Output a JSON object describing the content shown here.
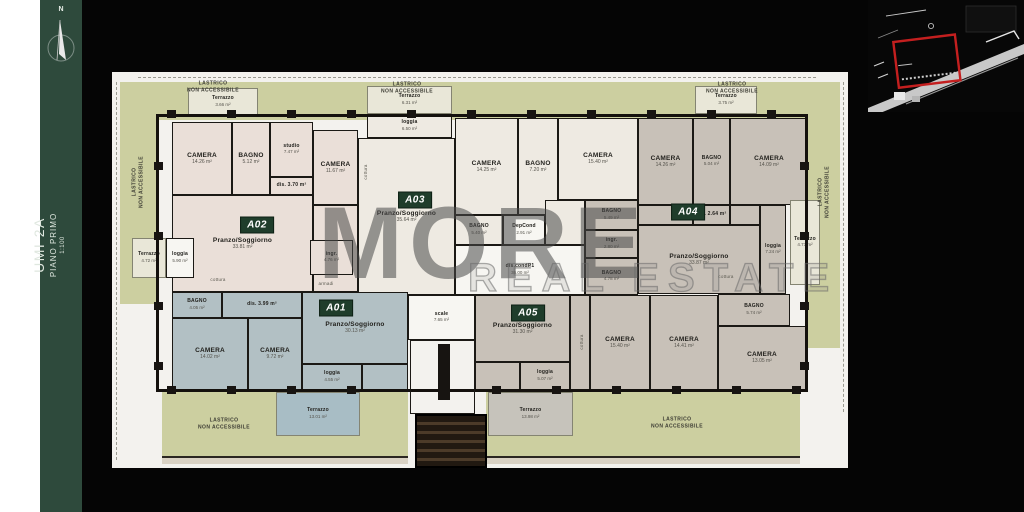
{
  "sidebar": {
    "north": "N",
    "title": "UMI 2A",
    "subtitle": "PIANO PRIMO",
    "scale": "1:100",
    "band_color": "#2e4a3c"
  },
  "watermark": {
    "primary": "MORE",
    "secondary": "REAL ESTATE"
  },
  "inset": {
    "highlight_color": "#c41f1f"
  },
  "palette": {
    "paper": "#f3f2ee",
    "green": "#cccfa0",
    "pale": "#e9e7d8",
    "wall": "#171411",
    "a01": "#b2c0c4",
    "a02": "#eadfd8",
    "a03": "#eeeae2",
    "a04": "#c8c1b8",
    "a05": "#c8c1b8",
    "wt": "#f7f6f2",
    "tblue": "#a8bdc5",
    "tgray": "#c6c3bb",
    "badge_bg": "#1f3d2b",
    "badge_fg": "#ffffff"
  },
  "plan": {
    "regions": [
      {
        "name": "lastrico-top",
        "fill": "green",
        "cls": "flat",
        "x": 26,
        "y": 10,
        "w": 678,
        "h": 38
      },
      {
        "name": "lastrico-left",
        "fill": "green",
        "cls": "flat",
        "x": 8,
        "y": 10,
        "w": 38,
        "h": 222
      },
      {
        "name": "lastrico-right",
        "fill": "green",
        "cls": "flat",
        "x": 694,
        "y": 10,
        "w": 34,
        "h": 266
      },
      {
        "name": "lastrico-bottom-left",
        "fill": "green",
        "cls": "flat",
        "x": 50,
        "y": 320,
        "w": 246,
        "h": 64
      },
      {
        "name": "lastrico-bottom-right",
        "fill": "green",
        "cls": "flat",
        "x": 374,
        "y": 320,
        "w": 314,
        "h": 64
      },
      {
        "name": "parapet-left",
        "cls": "bwall",
        "x": 50,
        "y": 384,
        "w": 246,
        "h": 8
      },
      {
        "name": "parapet-right",
        "cls": "bwall",
        "x": 374,
        "y": 384,
        "w": 314,
        "h": 8
      },
      {
        "name": "terrazzo-a02-top",
        "fill": "pale",
        "cls": "terr",
        "x": 76,
        "y": 16,
        "w": 70,
        "h": 28,
        "label": "Terrazzo",
        "area": "3.66 m²",
        "sm": 1
      },
      {
        "name": "terrazzo-a03-top",
        "fill": "pale",
        "cls": "terr",
        "x": 255,
        "y": 14,
        "w": 85,
        "h": 28,
        "label": "Terrazzo",
        "area": "6.31 m²",
        "sm": 1
      },
      {
        "name": "terrazzo-a04-top",
        "fill": "pale",
        "cls": "terr",
        "x": 583,
        "y": 14,
        "w": 62,
        "h": 28,
        "label": "Terrazzo",
        "area": "3.75 m²",
        "sm": 1
      },
      {
        "name": "room-a02-camera-1",
        "fill": "a02",
        "x": 60,
        "y": 50,
        "w": 60,
        "h": 73,
        "label": "CAMERA",
        "area": "14.26 m²"
      },
      {
        "name": "room-a02-bagno",
        "fill": "a02",
        "x": 120,
        "y": 50,
        "w": 38,
        "h": 73,
        "label": "BAGNO",
        "area": "5.12 m²"
      },
      {
        "name": "room-a02-studio",
        "fill": "a02",
        "x": 158,
        "y": 50,
        "w": 43,
        "h": 55,
        "label": "studio",
        "area": "7.47 m²",
        "sm": 1
      },
      {
        "name": "room-a02-dis",
        "fill": "a02",
        "x": 158,
        "y": 105,
        "w": 43,
        "h": 18,
        "label": "dis. 3.70 m²",
        "sm": 1
      },
      {
        "name": "room-a02-camera-2",
        "fill": "a02",
        "x": 201,
        "y": 58,
        "w": 45,
        "h": 75,
        "label": "CAMERA",
        "area": "11.67 m²"
      },
      {
        "name": "a02-hall",
        "fill": "a02",
        "x": 201,
        "y": 133,
        "w": 45,
        "h": 87
      },
      {
        "name": "room-a02-pranzo",
        "fill": "a02",
        "x": 60,
        "y": 123,
        "w": 141,
        "h": 97,
        "label": "Pranzo/Soggiorno",
        "area": "33.81 m²"
      },
      {
        "name": "room-a02-ingr",
        "fill": "a02",
        "x": 198,
        "y": 168,
        "w": 43,
        "h": 35,
        "label": "ingr.",
        "area": "4.76 m²",
        "sm": 1
      },
      {
        "name": "terrazzo-a02-left",
        "fill": "pale",
        "cls": "terr",
        "x": 20,
        "y": 166,
        "w": 34,
        "h": 40,
        "label": "Terrazzo",
        "area": "4.72 m²",
        "sm": 1
      },
      {
        "name": "room-a02-loggia",
        "fill": "wt",
        "x": 54,
        "y": 166,
        "w": 28,
        "h": 40,
        "label": "loggia",
        "area": "5.90 m²",
        "sm": 1
      },
      {
        "name": "room-a03-loggia",
        "fill": "a03",
        "x": 255,
        "y": 42,
        "w": 85,
        "h": 24,
        "label": "loggia",
        "area": "6.50 m²",
        "sm": 1
      },
      {
        "name": "room-a03-pranzo",
        "fill": "a03",
        "x": 246,
        "y": 66,
        "w": 97,
        "h": 157,
        "label": "Pranzo/Soggiorno",
        "area": "35.64 m²"
      },
      {
        "name": "room-a03-camera-1",
        "fill": "a03",
        "x": 343,
        "y": 46,
        "w": 63,
        "h": 97,
        "label": "CAMERA",
        "area": "14.25 m²"
      },
      {
        "name": "room-a03-bagno-1",
        "fill": "a03",
        "x": 406,
        "y": 46,
        "w": 40,
        "h": 97,
        "label": "BAGNO",
        "area": "7.20 m²"
      },
      {
        "name": "room-a03-camera-2",
        "fill": "a03",
        "x": 446,
        "y": 46,
        "w": 80,
        "h": 82,
        "label": "CAMERA",
        "area": "15.40 m²"
      },
      {
        "name": "a03-hall",
        "fill": "a03",
        "x": 433,
        "y": 128,
        "w": 40,
        "h": 45
      },
      {
        "name": "room-a03-bagno-2",
        "fill": "a03",
        "x": 343,
        "y": 143,
        "w": 48,
        "h": 30,
        "label": "BAGNO",
        "area": "5.40 m²",
        "sm": 1
      },
      {
        "name": "room-depcond",
        "fill": "wt",
        "x": 391,
        "y": 143,
        "w": 42,
        "h": 30,
        "label": "DepCond",
        "area": "2.91 m²",
        "sm": 1
      },
      {
        "name": "corridor-discond",
        "fill": "wt",
        "x": 343,
        "y": 173,
        "w": 130,
        "h": 50,
        "label": "dis.condP1",
        "area": "36.00 m²",
        "sm": 1
      },
      {
        "name": "room-a04-camera-1",
        "fill": "a04",
        "x": 526,
        "y": 46,
        "w": 55,
        "h": 87,
        "label": "CAMERA",
        "area": "14.26 m²"
      },
      {
        "name": "room-a04-bagno-1",
        "fill": "a04",
        "x": 581,
        "y": 46,
        "w": 37,
        "h": 87,
        "label": "BAGNO",
        "area": "5.04 m²",
        "sm": 1
      },
      {
        "name": "room-a04-camera-2",
        "fill": "a04",
        "x": 618,
        "y": 46,
        "w": 78,
        "h": 87,
        "label": "CAMERA",
        "area": "14.09 m²"
      },
      {
        "name": "room-a04-dis",
        "fill": "a04",
        "x": 581,
        "y": 133,
        "w": 37,
        "h": 20,
        "label": "dis. 2.64 m²",
        "sm": 1
      },
      {
        "name": "a04-hall",
        "fill": "a04",
        "x": 526,
        "y": 133,
        "w": 55,
        "h": 20
      },
      {
        "name": "a04-hall-2",
        "fill": "a04",
        "x": 618,
        "y": 133,
        "w": 30,
        "h": 20
      },
      {
        "name": "room-a04-bagno-2",
        "fill": "a04",
        "x": 473,
        "y": 128,
        "w": 53,
        "h": 30,
        "label": "BAGNO",
        "area": "5.49 m²",
        "sm": 1
      },
      {
        "name": "room-a04-ingr",
        "fill": "a04",
        "x": 473,
        "y": 158,
        "w": 53,
        "h": 28,
        "label": "ingr.",
        "area": "2.80 m²",
        "sm": 1
      },
      {
        "name": "room-a04-bagno-3",
        "fill": "a04",
        "x": 473,
        "y": 186,
        "w": 53,
        "h": 37,
        "label": "BAGNO",
        "area": "4.78 m²",
        "sm": 1
      },
      {
        "name": "room-a04-pranzo",
        "fill": "a04",
        "x": 526,
        "y": 153,
        "w": 122,
        "h": 69,
        "label": "Pranzo/Soggiorno",
        "area": "33.87 m²"
      },
      {
        "name": "room-a04-loggia",
        "fill": "a04",
        "x": 648,
        "y": 133,
        "w": 26,
        "h": 89,
        "label": "loggia",
        "area": "7.24 m²",
        "sm": 1
      },
      {
        "name": "terrazzo-a04-right",
        "fill": "pale",
        "cls": "terr",
        "x": 678,
        "y": 128,
        "w": 30,
        "h": 85,
        "label": "Terrazzo",
        "area": "4.73 m²",
        "sm": 1
      },
      {
        "name": "room-a05-pranzo",
        "fill": "a05",
        "x": 363,
        "y": 223,
        "w": 95,
        "h": 67,
        "label": "Pranzo/Soggiorno",
        "area": "31.30 m²"
      },
      {
        "name": "a05-hall",
        "fill": "a05",
        "x": 458,
        "y": 223,
        "w": 20,
        "h": 95
      },
      {
        "name": "a05-hall-2",
        "fill": "a05",
        "x": 363,
        "y": 290,
        "w": 45,
        "h": 28
      },
      {
        "name": "room-a05-camera-1",
        "fill": "a05",
        "x": 478,
        "y": 223,
        "w": 60,
        "h": 95,
        "label": "CAMERA",
        "area": "15.40 m²"
      },
      {
        "name": "room-a05-camera-2",
        "fill": "a05",
        "x": 538,
        "y": 223,
        "w": 68,
        "h": 95,
        "label": "CAMERA",
        "area": "14.41 m²"
      },
      {
        "name": "room-a05-bagno",
        "fill": "a05",
        "x": 606,
        "y": 222,
        "w": 72,
        "h": 32,
        "label": "BAGNO",
        "area": "5.74 m²",
        "sm": 1
      },
      {
        "name": "room-a05-camera-3",
        "fill": "a05",
        "x": 606,
        "y": 254,
        "w": 88,
        "h": 64,
        "label": "CAMERA",
        "area": "13.05 m²"
      },
      {
        "name": "room-a05-loggia",
        "fill": "a05",
        "x": 408,
        "y": 290,
        "w": 50,
        "h": 28,
        "label": "loggia",
        "area": "5.07 m²",
        "sm": 1
      },
      {
        "name": "terrazzo-a05",
        "fill": "tgray",
        "cls": "terr",
        "x": 376,
        "y": 320,
        "w": 85,
        "h": 44,
        "label": "Terrazzo",
        "area": "13.98 m²",
        "sm": 1
      },
      {
        "name": "room-a01-bagno",
        "fill": "a01",
        "x": 60,
        "y": 220,
        "w": 50,
        "h": 26,
        "label": "BAGNO",
        "area": "4.05 m²",
        "sm": 1
      },
      {
        "name": "room-a01-dis",
        "fill": "a01",
        "x": 110,
        "y": 220,
        "w": 80,
        "h": 26,
        "label": "dis. 3.99 m²",
        "sm": 1
      },
      {
        "name": "room-a01-camera-1",
        "fill": "a01",
        "x": 60,
        "y": 246,
        "w": 76,
        "h": 72,
        "label": "CAMERA",
        "area": "14.02 m²"
      },
      {
        "name": "room-a01-camera-2",
        "fill": "a01",
        "x": 136,
        "y": 246,
        "w": 54,
        "h": 72,
        "label": "CAMERA",
        "area": "9.72 m²"
      },
      {
        "name": "room-a01-pranzo",
        "fill": "a01",
        "x": 190,
        "y": 220,
        "w": 106,
        "h": 72,
        "label": "Pranzo/Soggiorno",
        "area": "30.13 m²"
      },
      {
        "name": "room-a01-loggia",
        "fill": "a01",
        "x": 190,
        "y": 292,
        "w": 60,
        "h": 26,
        "label": "loggia",
        "area": "4.55 m²",
        "sm": 1
      },
      {
        "name": "a01-hall",
        "fill": "a01",
        "x": 250,
        "y": 292,
        "w": 46,
        "h": 26
      },
      {
        "name": "terrazzo-a01",
        "fill": "tblue",
        "cls": "terr",
        "x": 164,
        "y": 320,
        "w": 84,
        "h": 44,
        "label": "Terrazzo",
        "area": "13.01 m²",
        "sm": 1
      },
      {
        "name": "room-scale",
        "fill": "wt",
        "x": 296,
        "y": 223,
        "w": 67,
        "h": 45,
        "label": "scale",
        "area": "7.65 m²",
        "sm": 1
      },
      {
        "name": "building-outline",
        "cls": "outline",
        "x": 44,
        "y": 42,
        "w": 652,
        "h": 278
      },
      {
        "name": "stairs-internal",
        "cls": "stairs",
        "x": 298,
        "y": 268,
        "w": 65,
        "h": 74
      },
      {
        "name": "stair-core",
        "fill": "wall",
        "cls": "flat",
        "x": 326,
        "y": 272,
        "w": 12,
        "h": 56
      },
      {
        "name": "stairs-external",
        "cls": "ext",
        "x": 303,
        "y": 342,
        "w": 72,
        "h": 54
      }
    ],
    "texts": [
      {
        "name": "lastrico-label-top-left",
        "cls": "last",
        "x": 101,
        "y": 15,
        "lines": [
          "LASTRICO",
          "NON ACCESSIBILE"
        ]
      },
      {
        "name": "lastrico-label-top-center",
        "cls": "last",
        "x": 295,
        "y": 16,
        "lines": [
          "LASTRICO",
          "NON ACCESSIBILE"
        ]
      },
      {
        "name": "lastrico-label-top-right",
        "cls": "last",
        "x": 620,
        "y": 16,
        "lines": [
          "LASTRICO",
          "NON ACCESSIBILE"
        ]
      },
      {
        "name": "lastrico-label-bottom-left",
        "cls": "last",
        "x": 112,
        "y": 352,
        "lines": [
          "LASTRICO",
          "NON ACCESSIBILE"
        ]
      },
      {
        "name": "lastrico-label-bottom-right",
        "cls": "last",
        "x": 565,
        "y": 351,
        "lines": [
          "LASTRICO",
          "NON ACCESSIBILE"
        ]
      },
      {
        "name": "lastrico-label-left-vertical",
        "cls": "lastv",
        "x": 26,
        "y": 110,
        "lines": [
          "LASTRICO",
          "NON ACCESSIBILE"
        ]
      },
      {
        "name": "lastrico-label-right-vertical",
        "cls": "lastv",
        "x": 712,
        "y": 120,
        "lines": [
          "LASTRICO",
          "NON ACCESSIBILE"
        ]
      },
      {
        "name": "cottura-a02",
        "cls": "tiny",
        "x": 106,
        "y": 208,
        "text": "cottura"
      },
      {
        "name": "cottura-a03",
        "cls": "tiny tv",
        "x": 254,
        "y": 100,
        "text": "cottura"
      },
      {
        "name": "cottura-a04",
        "cls": "tiny",
        "x": 614,
        "y": 205,
        "text": "cottura"
      },
      {
        "name": "cottura-a05",
        "cls": "tiny tv",
        "x": 470,
        "y": 270,
        "text": "cottura"
      },
      {
        "name": "armadi-a02",
        "cls": "tiny",
        "x": 214,
        "y": 212,
        "text": "armadi"
      }
    ],
    "badges": [
      {
        "id": "A01",
        "x": 224,
        "y": 236
      },
      {
        "id": "A02",
        "x": 145,
        "y": 153
      },
      {
        "id": "A03",
        "x": 303,
        "y": 128
      },
      {
        "id": "A04",
        "x": 576,
        "y": 140
      },
      {
        "id": "A05",
        "x": 416,
        "y": 241
      }
    ],
    "pilasters": [
      [
        55,
        38
      ],
      [
        115,
        38
      ],
      [
        175,
        38
      ],
      [
        235,
        38
      ],
      [
        295,
        38
      ],
      [
        355,
        38
      ],
      [
        415,
        38
      ],
      [
        475,
        38
      ],
      [
        535,
        38
      ],
      [
        595,
        38
      ],
      [
        655,
        38
      ],
      [
        55,
        314
      ],
      [
        115,
        314
      ],
      [
        175,
        314
      ],
      [
        235,
        314
      ],
      [
        380,
        314
      ],
      [
        440,
        314
      ],
      [
        500,
        314
      ],
      [
        560,
        314
      ],
      [
        620,
        314
      ],
      [
        680,
        314
      ],
      [
        42,
        90
      ],
      [
        42,
        160
      ],
      [
        42,
        230
      ],
      [
        42,
        290
      ],
      [
        688,
        90
      ],
      [
        688,
        160
      ],
      [
        688,
        230
      ],
      [
        688,
        290
      ]
    ]
  }
}
